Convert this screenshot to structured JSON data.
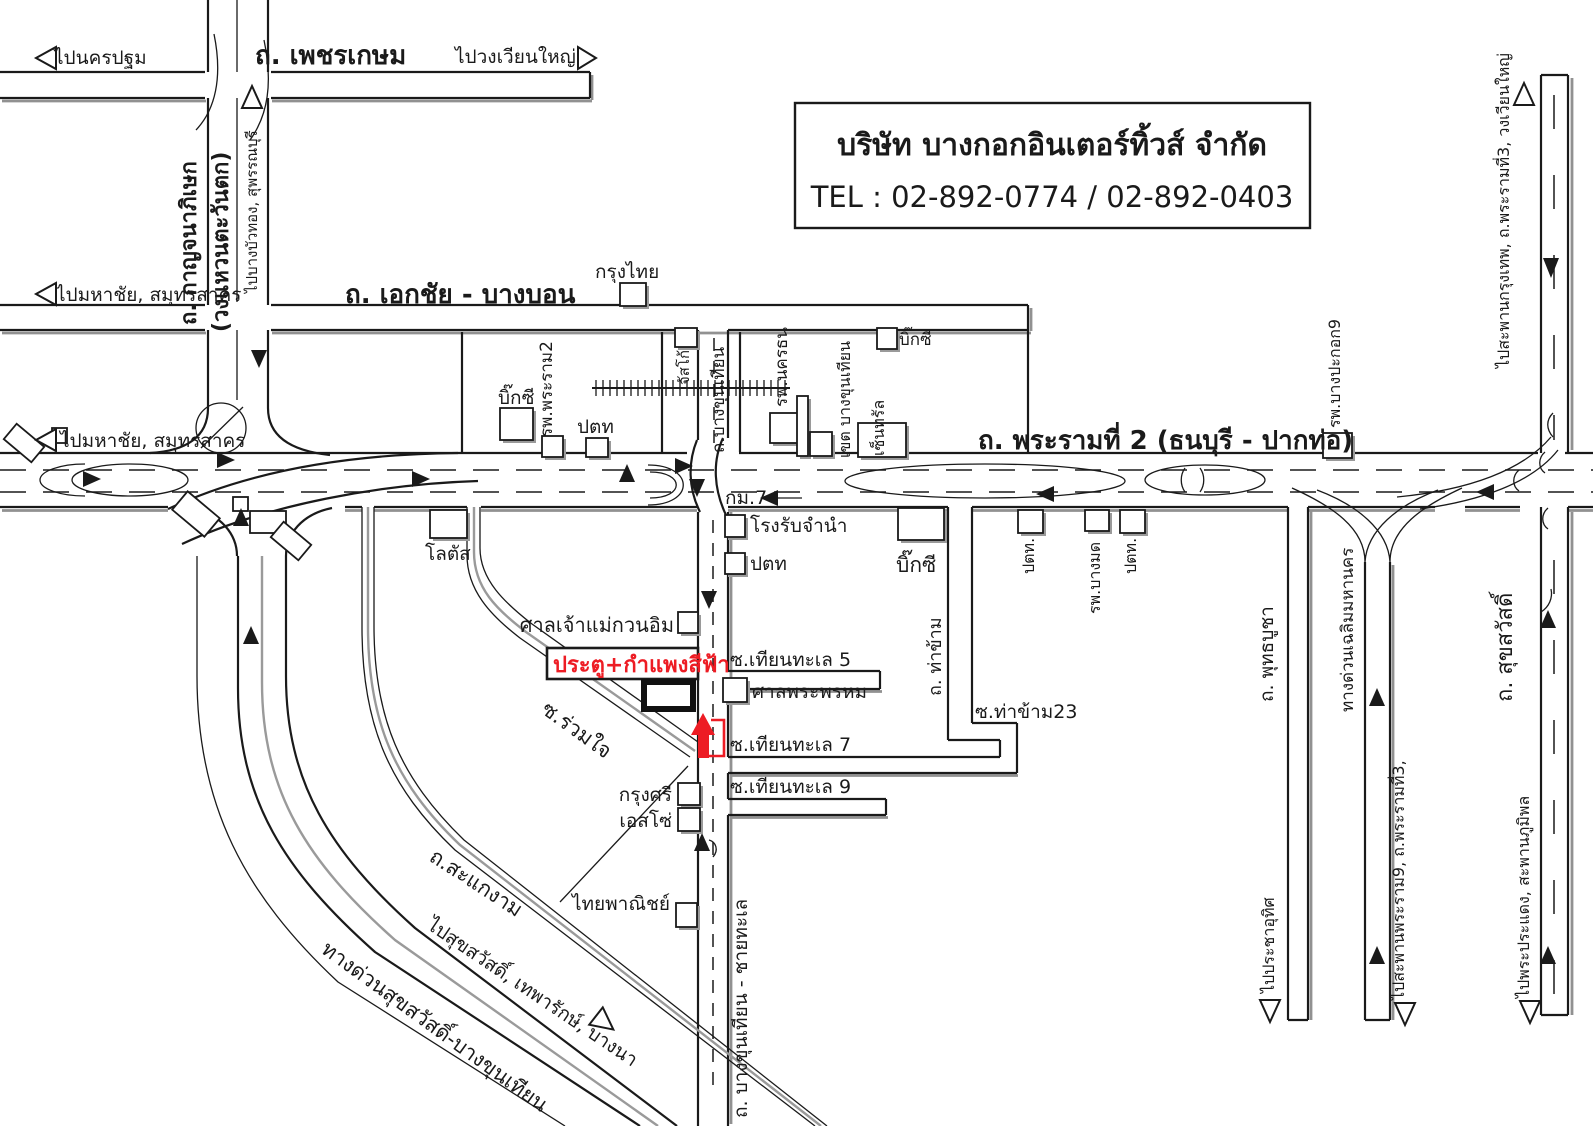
{
  "company_box": {
    "name": "บริษัท บางกอกอินเตอร์ทิ้วส์ จำกัด",
    "tel": "TEL : 02-892-0774 / 02-892-0403"
  },
  "colors": {
    "accent_red": "#ed1c24",
    "line_black": "#1a1a1a",
    "shadow_gray": "#9a9a9a"
  },
  "labels": {
    "to_nakhonpathom": "ไปนครปฐม",
    "phetkasem_rd": "ถ. เพชรเกษม",
    "to_wongwianyai": "ไปวงเวียนใหญ่",
    "kanchanaphisek_rd": "ถ. กาญจนาภิเษก",
    "west_ring": "(วงแหวนตะวันตก)",
    "to_bangbuathong": "ไปบางบัวทอง, สุพรรณบุรี",
    "to_mahachai": "ไปมหาชัย, สมุทรสาคร",
    "ekkachai_bangbon_rd": "ถ. เอกชัย - บางบอน",
    "krungthai": "กรุงไทย",
    "bigc": "บิ๊กซี",
    "rp_phrarama2": "รพ.พระราม2",
    "ptt": "ปตท",
    "ptt_dot": "ปตท.",
    "jusco": "จัสโก้",
    "bangkhunthian_rd": "ถ.บางขุนเทียน",
    "rp_nakhonthon": "รพ.นครธน",
    "khet_bangkhunthian": "เขต บางขุนเทียน",
    "central": "เซ็นทรัล",
    "rama2_rd": "ถ. พระรามที่ 2 (ธนบุรี - ปากท่อ)",
    "rp_bangpakok9": "รพ.บางปะกอก9",
    "to_krungthep_bridge": "ไปสะพานกรุงเทพ, ถ.พระรามที่3, วงเวียนใหญ่",
    "km7": "กม.7",
    "pawnshop": "โรงรับจำนำ",
    "lotus": "โลตัส",
    "thakham_rd": "ถ. ท่าข้าม",
    "rp_bangmod": "รพ.บางมด",
    "phutthabucha_rd": "ถ. พุทธบูชา",
    "chalerm_expressway": "ทางด่วนเฉลิมมหานคร",
    "suksawat_rd": "ถ. สุขสวัสดิ์",
    "guanim_shrine": "ศาลเจ้าแม่กวนอิม",
    "blue_gate_note": "ประตู+กำแพงสีฟ้า",
    "soi_thianthale5": "ซ.เทียนทะเล 5",
    "phra_phrom_shrine": "ศาลพระพรหม",
    "soi_ruamjai": "ซ.ร่วมใจ",
    "soi_thianthale7": "ซ.เทียนทะเล 7",
    "soi_thianthale9": "ซ.เทียนทะเล 9",
    "krungsri": "กรุงศรี",
    "esso": "เอสโซ่",
    "scb": "ไทยพาณิชย์",
    "sakaengam_rd": "ถ.สะแกงาม",
    "to_suksawat": "ไปสุขสวัสดิ์, เทพารักษ์, บางนา",
    "suksawat_expressway": "ทางด่วนสุขสวัสดิ์-บางขุนเทียน",
    "bangkhunthian_chaithale_rd": "ถ. บางขุนเทียน - ชายทะเล",
    "soi_thakham23": "ซ.ท่าข้าม23",
    "to_prachauthit": "ไปประชาอุทิศ",
    "to_rama9_bridge": "ไปสะพานพระราม9, ถ.พระรามที่3,",
    "to_phrapradaeng": "ไปพระประแดง, สะพานภูมิพล"
  }
}
